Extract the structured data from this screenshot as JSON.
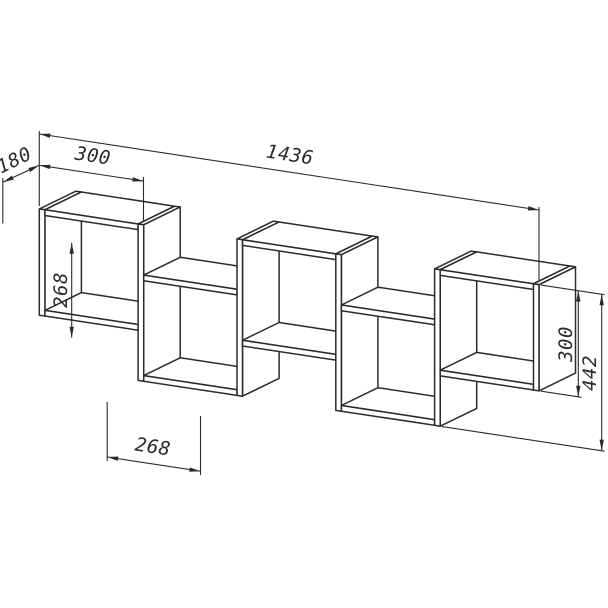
{
  "page": {
    "background": "#ffffff"
  },
  "drawing": {
    "subject": "wall shelf technical drawing",
    "line_color": "#2b2b2b",
    "dimensions": {
      "total_width": "1436",
      "box_width": "300",
      "depth": "180",
      "inner_height": "268",
      "bottom_inner_width": "268",
      "right_box_height": "300",
      "total_height": "442"
    }
  }
}
